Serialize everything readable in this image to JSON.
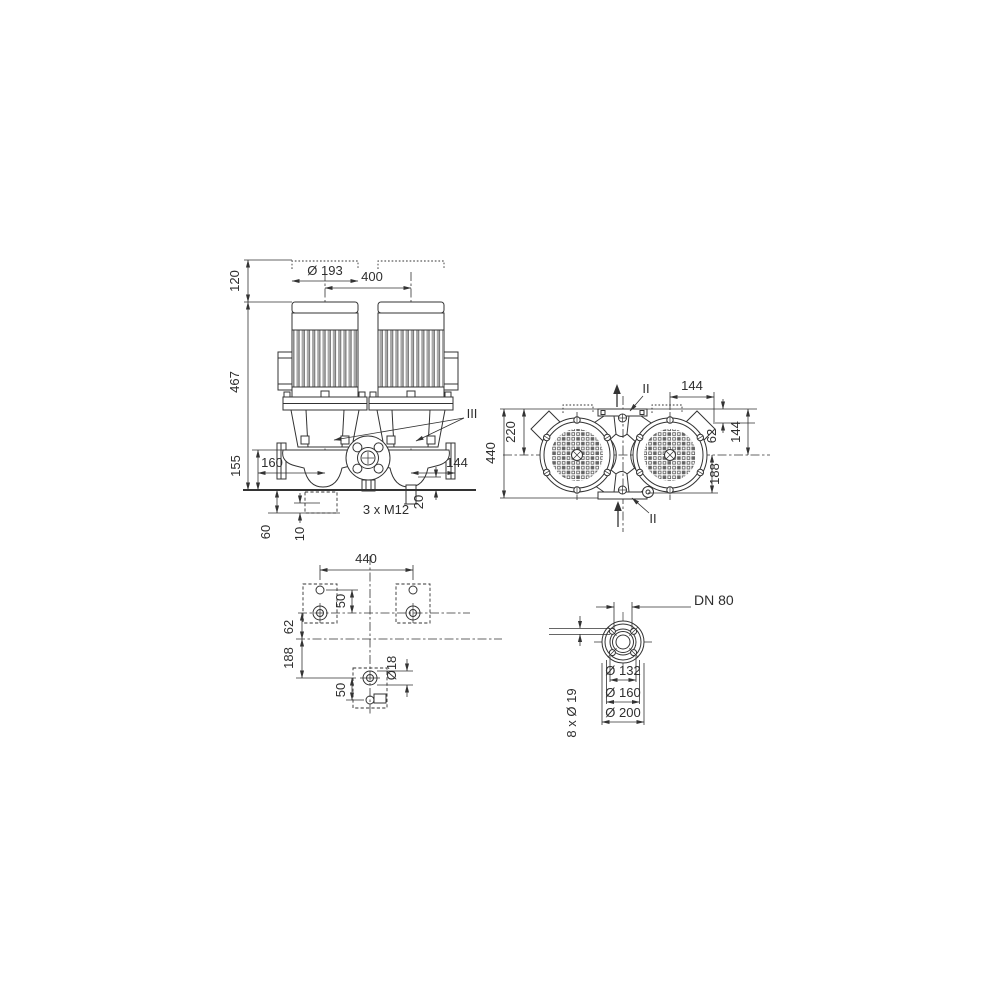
{
  "drawing": {
    "background": "#ffffff",
    "line_color": "#333333",
    "front_view": {
      "dim_phantom_height": "120",
      "dim_total_height": "467",
      "dim_base_height": "155",
      "dim_motor_diameter": "Ø 193",
      "dim_pump_spacing": "400",
      "dim_axis_to_left": "160",
      "dim_axis_to_right": "144",
      "dim_drain_clearance": "20",
      "drain_plug_label": "3 x M12",
      "dim_pad_depth": "60",
      "dim_pad_offset": "10",
      "section_label": "III"
    },
    "top_view": {
      "dim_box_width": "144",
      "dim_flange_to_box": "62",
      "dim_flange_to_axis": "144",
      "dim_axis_to_flange": "188",
      "dim_half_length": "220",
      "dim_port_to_port": "440",
      "section_label_top": "II",
      "section_label_bottom": "II"
    },
    "foundation_view": {
      "dim_bolt_spacing": "440",
      "dim_hole_spacing_top": "50",
      "dim_axis_offset": "62",
      "dim_axis_to_bottom": "188",
      "dim_hole_spacing_bottom": "50",
      "dim_hole_diameter": "Ø18"
    },
    "flange_view": {
      "nominal_label": "DN 80",
      "dim_raised_face": "Ø 132",
      "dim_bolt_circle": "Ø 160",
      "dim_outer_diameter": "Ø 200",
      "bolt_holes_label": "8 x Ø 19"
    }
  }
}
